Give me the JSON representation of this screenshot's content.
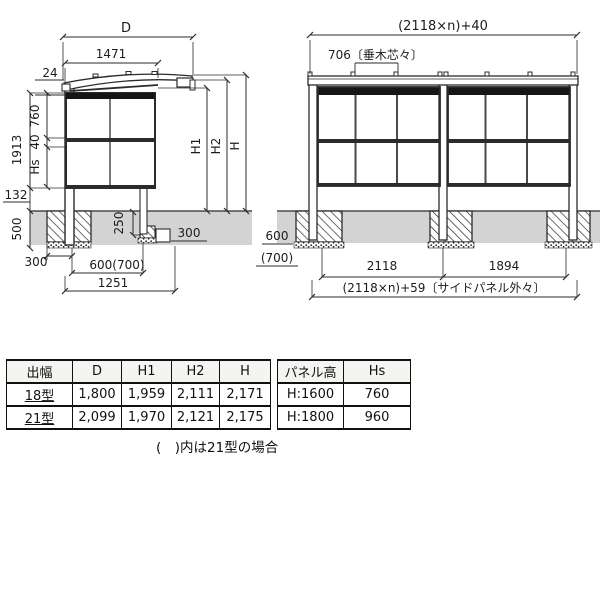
{
  "colors": {
    "line": "#2b2b2b",
    "ground_fill": "#d3d3d3",
    "dark_bar": "#161616",
    "table_header_bg": "#f4f4f1"
  },
  "side_view": {
    "dims": {
      "d_label": "D",
      "roof_depth": "1471",
      "roof_edge": "24",
      "panel_upper": "760",
      "panel_rail": "40",
      "panel_lower": "Hs",
      "panel_total": "1913",
      "ground_clearance": "132",
      "embed_depth": "500",
      "footing_offset": "300",
      "footing_depth": "250",
      "block_width": "300",
      "footing_span": "600(700)",
      "base_span": "1251",
      "h1": "H1",
      "h2": "H2",
      "h": "H"
    }
  },
  "front_view": {
    "dims": {
      "overall_width": "(2118×n)+40",
      "rafter_pitch": "706〔垂木芯々〕",
      "embed_depth": "600",
      "embed_depth_alt": "(700)",
      "bay_span": "2118",
      "end_span": "1894",
      "overall_bottom": "(2118×n)+59〔サイドパネル外々〕"
    }
  },
  "size_table": {
    "headers": [
      "出幅",
      "D",
      "H1",
      "H2",
      "H"
    ],
    "rows": [
      {
        "type": "18型",
        "d": "1,800",
        "h1": "1,959",
        "h2": "2,111",
        "h": "2,171"
      },
      {
        "type": "21型",
        "d": "2,099",
        "h1": "1,970",
        "h2": "2,121",
        "h": "2,175"
      }
    ]
  },
  "panel_table": {
    "headers": [
      "パネル高",
      "Hs"
    ],
    "rows": [
      {
        "height": "H:1600",
        "hs": "760"
      },
      {
        "height": "H:1800",
        "hs": "960"
      }
    ]
  },
  "note": "(　)内は21型の場合"
}
